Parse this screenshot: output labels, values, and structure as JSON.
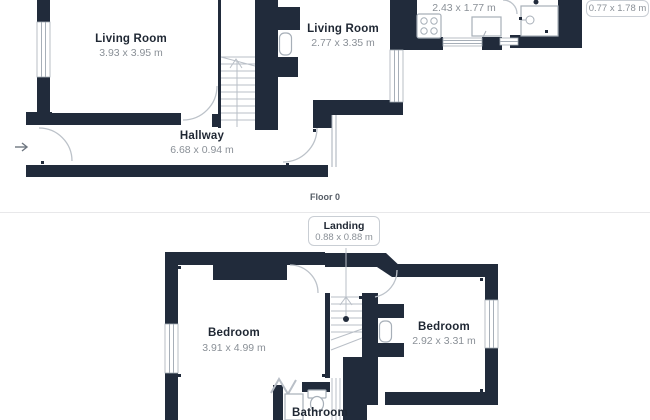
{
  "floorplan": {
    "floor0": {
      "caption": "Floor 0",
      "living_room_1": {
        "name": "Living Room",
        "dims": "3.93 x 3.95 m"
      },
      "living_room_2": {
        "name": "Living Room",
        "dims": "2.77 x 3.35 m"
      },
      "hallway": {
        "name": "Hallway",
        "dims": "6.68 x 0.94 m"
      },
      "kitchen": {
        "dims": "2.43 x 1.77 m"
      },
      "shower_room_badge": {
        "dims": "0.77 x 1.78 m"
      }
    },
    "floor1": {
      "landing_badge": {
        "name": "Landing",
        "dims": "0.88 x 0.88 m"
      },
      "bedroom_1": {
        "name": "Bedroom",
        "dims": "3.91 x 4.99 m"
      },
      "bedroom_2": {
        "name": "Bedroom",
        "dims": "2.92 x 3.31 m"
      },
      "bathroom": {
        "name": "Bathroom"
      }
    }
  },
  "colors": {
    "wall": "#212B3B",
    "room_name": "#1F2733",
    "dim_text": "#8A9097",
    "caption_text": "#565D66",
    "arc": "#BCC2C9",
    "fixture": "#A7AFB8",
    "stair_line": "#B9BFC7",
    "divider": "#E8E8EA",
    "badge_border": "#C9CED4"
  }
}
